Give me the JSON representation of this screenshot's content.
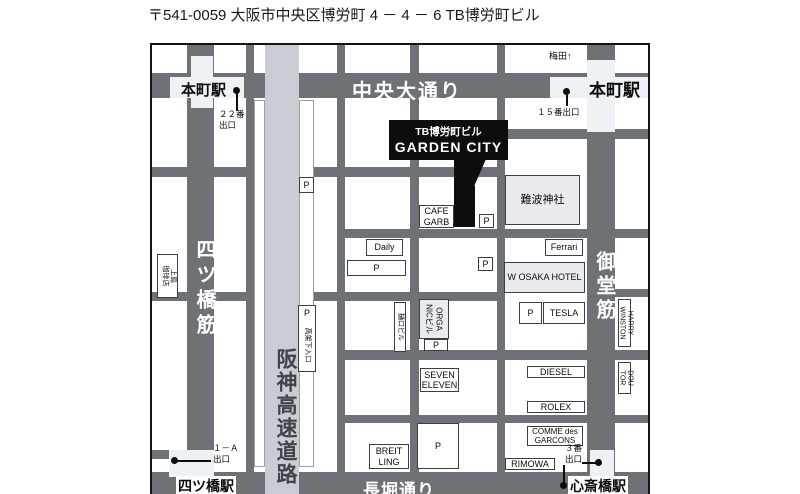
{
  "title": "〒541-0059 大阪市中央区博労町 4 － 4 － 6 TB博労町ビル",
  "map": {
    "roads": {
      "chuo_odori": "中央大通り",
      "nagahori_dori": "長堀通り",
      "yotsubashi_suji": "四ツ橋筋",
      "midosuji": "御堂筋",
      "hanshin_expressway": "阪神高速道路"
    },
    "direction_umeda": "梅田↑",
    "stations": {
      "hommachi_west": "本町駅",
      "hommachi_east": "本町駅",
      "yotsubashi": "四ツ橋駅",
      "shinsaibashi": "心斎橋駅"
    },
    "exits": {
      "exit_22": "２２番\n出口",
      "exit_15": "１５番出口",
      "exit_1a": "１－Ａ\n出口",
      "exit_3": "３番\n出口"
    },
    "callout": {
      "building": "TB博労町ビル",
      "name": "GARDEN CITY"
    },
    "parking_label": "P",
    "landmarks": {
      "cafe_garb": "CAFE\nGARB",
      "namba_shrine": "難波神社",
      "daily": "Daily",
      "ferrari": "Ferrari",
      "w_osaka_hotel": "W OSAKA HOTEL",
      "tesla": "TESLA",
      "seven_eleven": "SEVEN\nELEVEN",
      "diesel": "DIESEL",
      "rolex": "ROLEX",
      "comme_des_garcons": "COMME des\nGARCONS",
      "rimowa": "RIMOWA",
      "breitling": "BREIT\nLING",
      "organic_bldg": "ORGA\nNICビル",
      "higuchi_bldg": "樋口ビル",
      "harry_winston": "HARRY\nWINSTON",
      "doutor": "DOU\nTOR",
      "ueshima_coffee": "上島\n珈琲店",
      "kokashita_entrance": "高架下入口"
    },
    "colors": {
      "road": "#6e7176",
      "expressway_strip": "#c9ccd2",
      "station_fill": "#eef1f5",
      "block_fill": "#e9ebef",
      "callout_bg": "#0d0d0d"
    }
  }
}
